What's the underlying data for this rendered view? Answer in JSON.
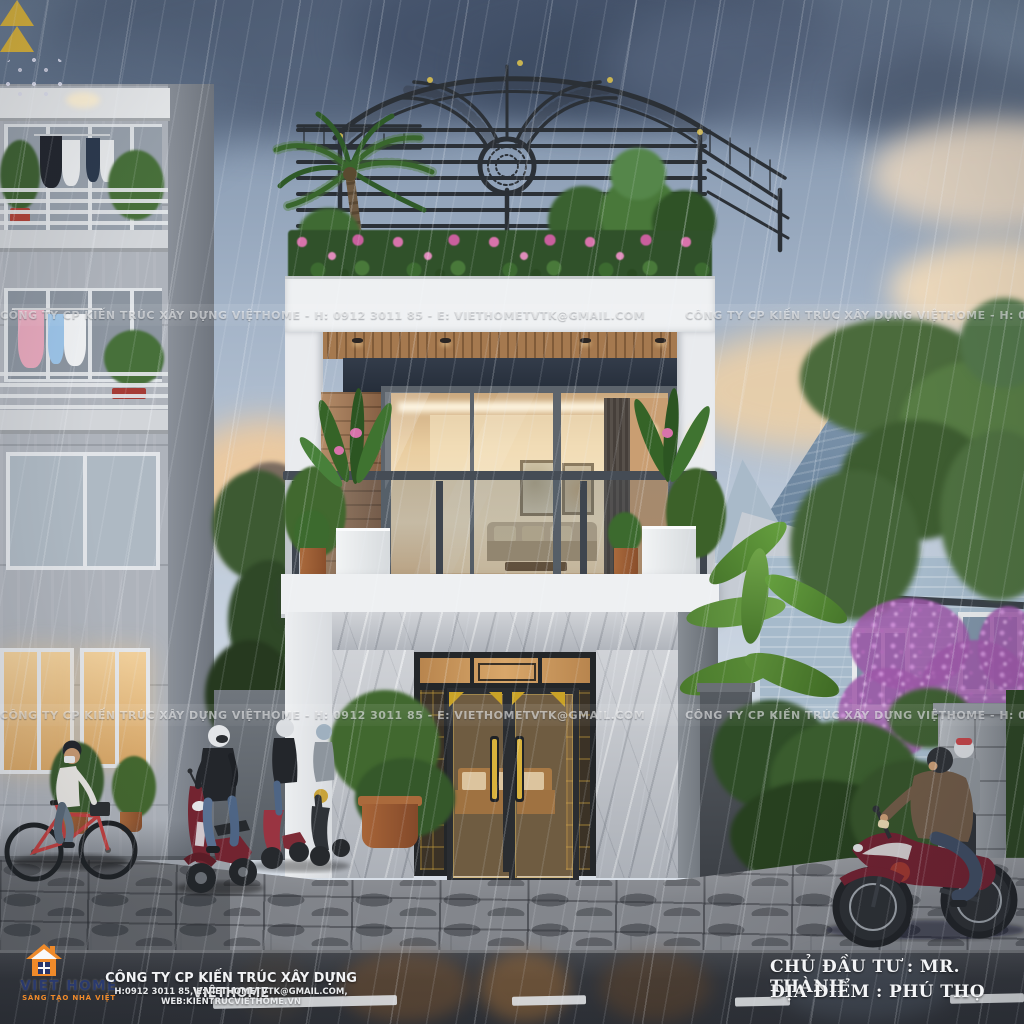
{
  "watermark": {
    "text": "CÔNG TY CP KIẾN TRÚC XÂY DỰNG VIỆTHOME  -  H: 0912 3011 85  -  E: VIETHOMETVTK@GMAIL.COM"
  },
  "brand": {
    "name": "VIET HOME",
    "tagline": "SÁNG TẠO NHÀ VIỆT",
    "icon": "house-icon"
  },
  "footer": {
    "company": "CÔNG TY CP KIẾN TRÚC XÂY DỰNG VIỆTHOME",
    "contact": "H:0912 3011 85, E:VIETHOMETVTK@GMAIL.COM, WEB:KIENTRUCVIETHOME.VN"
  },
  "project": {
    "owner": "CHỦ ĐẦU TƯ : MR. THÀNH",
    "location": "ĐỊA ĐIỂM :  PHÚ THỌ"
  },
  "colors": {
    "brand_orange": "#ef8a2a",
    "brand_navy": "#2a3a6e",
    "accent_gold": "#c9a227",
    "door_bronze": "#26292e",
    "wood_soffit": "#a5794f",
    "accent_panel": "#2b3340",
    "vehicle_maroon": "#6e2130",
    "sky_grey_blue": "#8b9db4",
    "sunset_cream": "#edd9bc",
    "foliage_green": "#41682f",
    "marble_grey": "#b7bbc2"
  }
}
